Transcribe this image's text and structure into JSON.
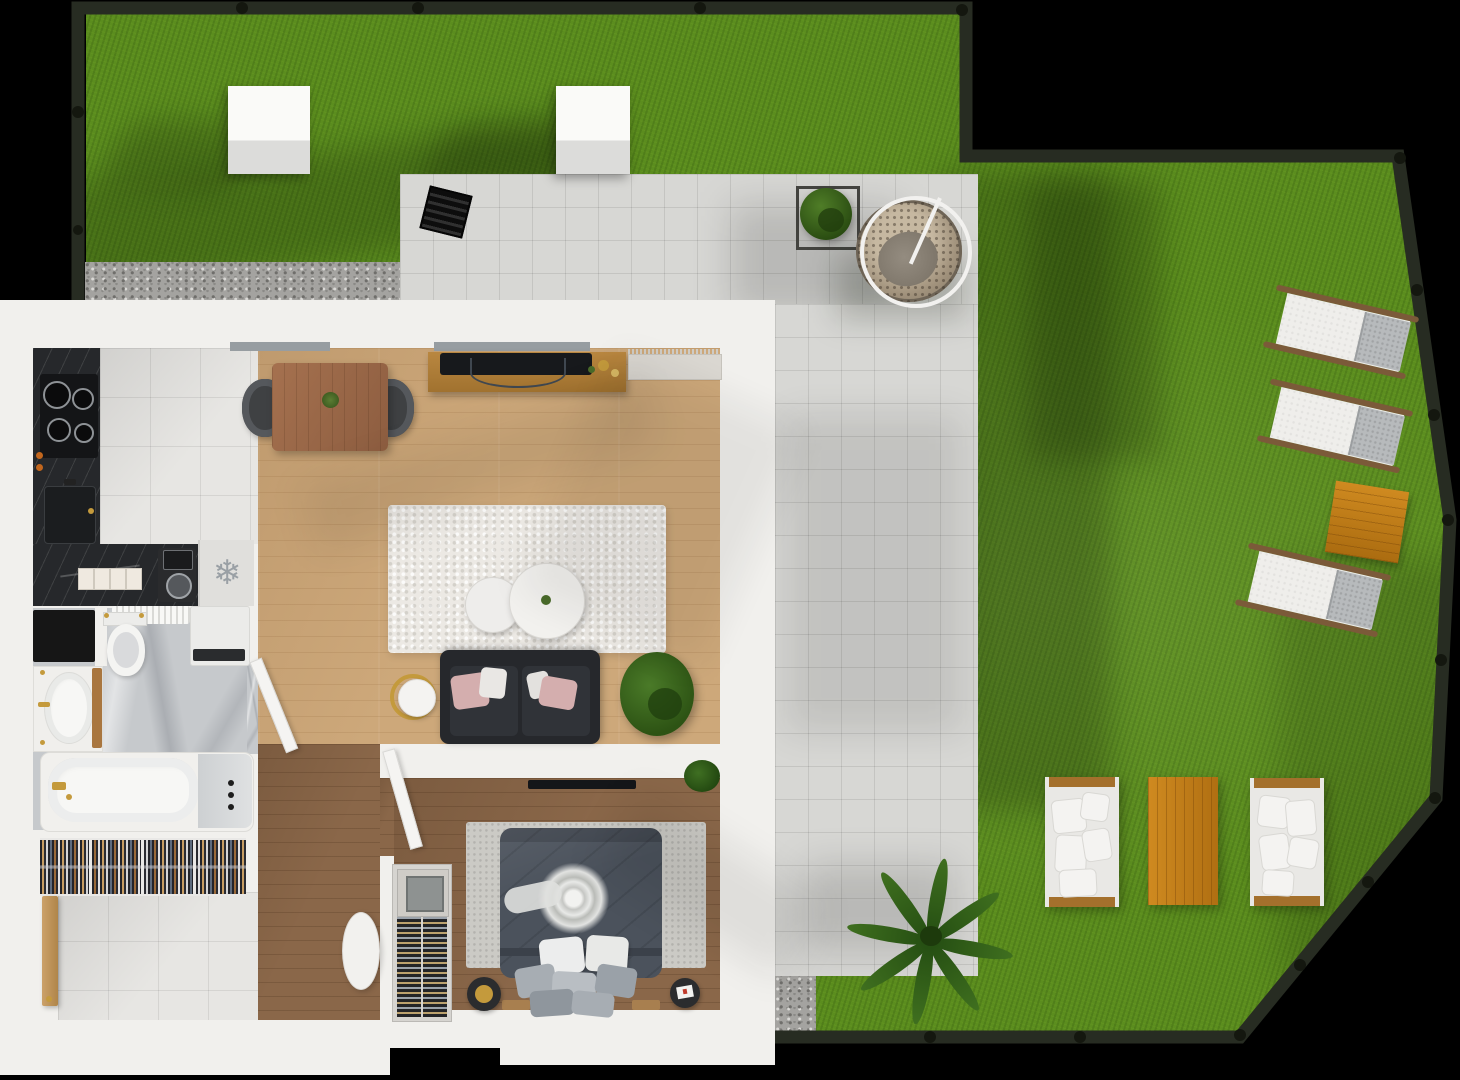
{
  "meta": {
    "kind": "3d-floor-plan-render",
    "view": "top-down axonometric",
    "scene": "one-bedroom apartment with wrap-around garden terrace",
    "visible_text": "none"
  },
  "glyphs": {
    "fridge_snowflake": "❄"
  },
  "palette": {
    "background": "#000000",
    "fence": "#272c22",
    "fence_post": "#14170f",
    "grass": "#5b8d1e",
    "paving": "#d7d7d4",
    "gravel": "#a4a3a0",
    "wall": "#f1f0ed",
    "wood_floor": "#cda87a",
    "wood_dark": "#8a6749",
    "tile": "#e7e6e3",
    "counter": "#26282b",
    "bath_floor": "#c6c9cc",
    "rug_living": "#ece9e4",
    "rug_bedroom": "#cbcac5",
    "sofa_dark": "#26282c",
    "bed_duvet": "#4b525c",
    "gold": "#c49a3c",
    "pink": "#d4aeae",
    "orange_wood": "#c9831d",
    "lounger_wood": "#7b5a39",
    "white_furniture": "#efeeeb",
    "plant_green": "#3c5f1e"
  },
  "garden": {
    "areas": [
      "upper-lawn",
      "main-lawn",
      "paved-terrace",
      "gravel-strip",
      "gravel-patch"
    ],
    "items": [
      {
        "name": "skylight-cube",
        "count": 2,
        "color": "#f8f8f6"
      },
      {
        "name": "floor-grate",
        "color": "#121212"
      },
      {
        "name": "planter-box-with-bush"
      },
      {
        "name": "hanging-egg-chair",
        "material": "rattan",
        "frame": "white"
      },
      {
        "name": "sun-lounger",
        "count": 3,
        "cushion": "white/grey",
        "frame": "wood"
      },
      {
        "name": "square-side-table",
        "material": "teak"
      },
      {
        "name": "outdoor-sofa",
        "count": 2,
        "cushions": "white"
      },
      {
        "name": "outdoor-coffee-table",
        "material": "teak"
      },
      {
        "name": "palm-plant"
      }
    ]
  },
  "apartment": {
    "rooms": [
      {
        "name": "kitchen",
        "floor": "grey-tile",
        "items": [
          "induction-hob",
          "kitchen-sink",
          "marble-counter",
          "cutting-boards",
          "coffee-machine",
          "fridge-freezer"
        ]
      },
      {
        "name": "living-dining",
        "floor": "light-wood",
        "items": [
          "dining-table",
          "dining-chair-left",
          "dining-chair-right",
          "tv-sideboard",
          "television",
          "window",
          "terrace-doormat",
          "shag-rug",
          "round-coffee-table-small",
          "round-coffee-table-large",
          "sofa-with-pillows",
          "round-side-table",
          "potted-plant"
        ]
      },
      {
        "name": "bathroom",
        "floor": "marble",
        "items": [
          "dark-mat",
          "radiator",
          "toilet",
          "washing-machine",
          "vanity-sink",
          "wood-bath-mat",
          "bathtub",
          "shower-controls",
          "door"
        ]
      },
      {
        "name": "wardrobe-nook",
        "items": [
          "open-wardrobe-hanging-clothes"
        ]
      },
      {
        "name": "entrance-hall",
        "floor": "grey-tile",
        "items": [
          "entrance-door",
          "pouf"
        ]
      },
      {
        "name": "bedroom",
        "floor": "dark-wood",
        "items": [
          "wall-tv",
          "double-bed",
          "bedroom-rug",
          "wine-cabinet",
          "nightstand-stool-left",
          "nightstand-stool-right",
          "corner-plant",
          "door"
        ]
      }
    ]
  }
}
